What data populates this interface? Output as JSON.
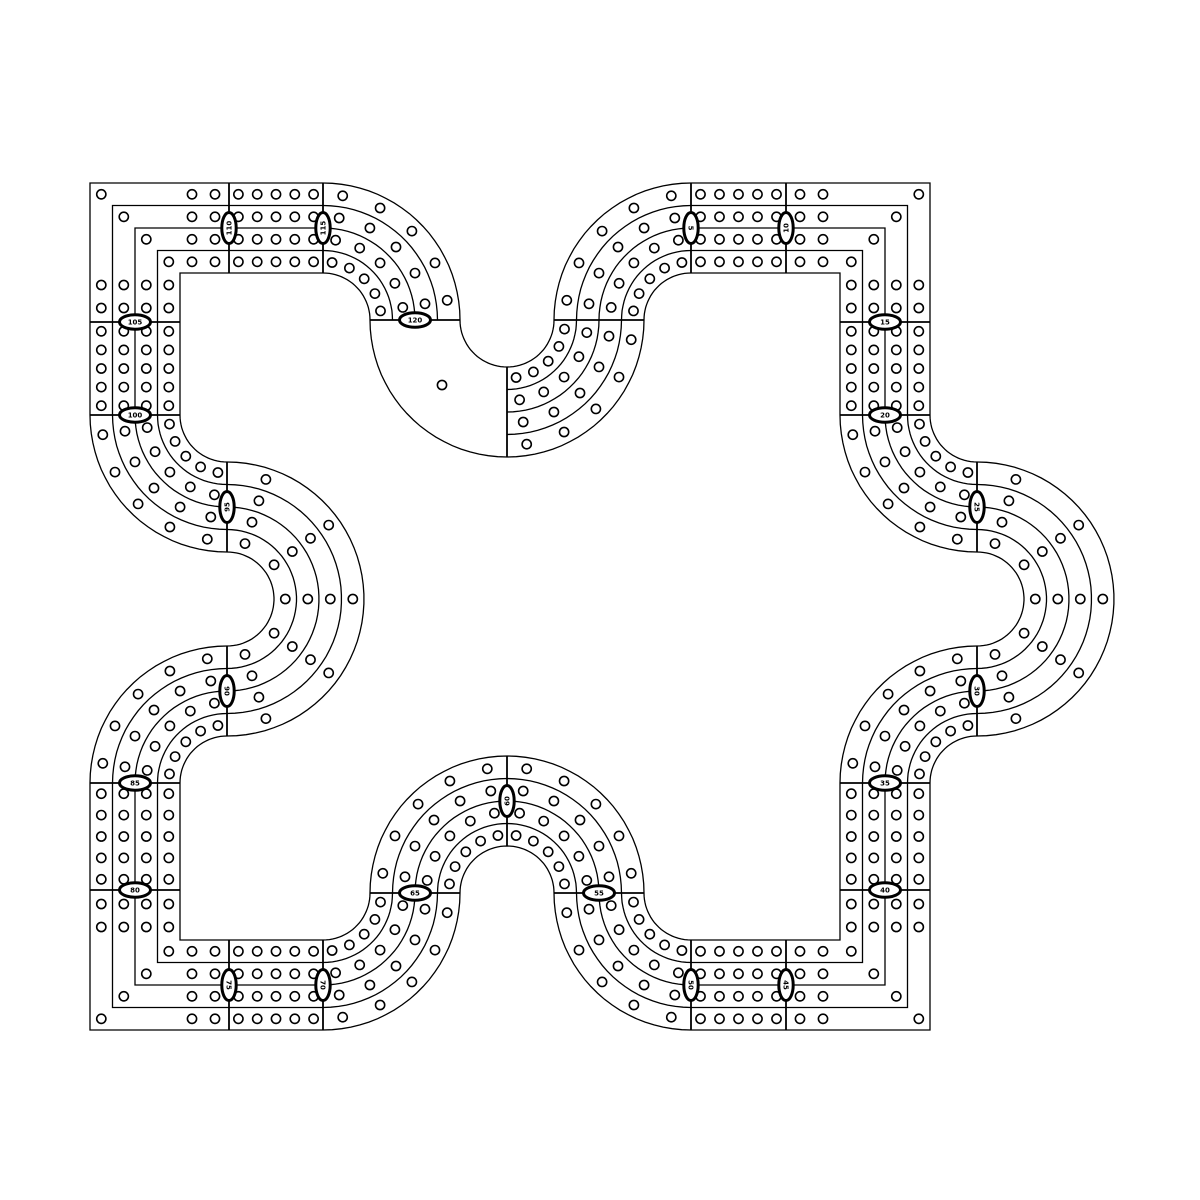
{
  "page": {
    "background": "#ffffff"
  },
  "drawing": {
    "description": "Modular four-lane cribbage race track template, black line art on white",
    "ink": "#000000",
    "background": "#ffffff",
    "lane_count": 4,
    "holes_per_module": 5,
    "modules": 25,
    "hole_radius": 4.6,
    "band_width": 90,
    "arc_radius": 92,
    "line_offsets": [
      45,
      22.5,
      0,
      -22.5,
      -45
    ],
    "lane_offsets": [
      33.75,
      11.25,
      -11.25,
      -33.75
    ],
    "corner_hole_insets": [
      14,
      37
    ],
    "stroke": {
      "track": 1.3,
      "boundary": 1.8,
      "hole": 1.6,
      "marker_ring": 3
    },
    "marker_ellipse": {
      "rx": 15.5,
      "ry": 7.2,
      "font_size": 7
    },
    "start_line_note": "vertical start line at top center",
    "finish_hole": {
      "x": 442,
      "y": 385
    },
    "segments": [
      {
        "t": "arc",
        "cx": 507,
        "cy": 320,
        "a0": 90,
        "a1": 0,
        "marker": null
      },
      {
        "t": "arc",
        "cx": 691,
        "cy": 320,
        "a0": 180,
        "a1": 270,
        "marker": "5"
      },
      {
        "t": "line",
        "x1": 691,
        "y1": 228,
        "x2": 786,
        "y2": 228,
        "marker": "10"
      },
      {
        "t": "corner",
        "vx": 885,
        "vy": 228,
        "sx": 1,
        "sy": -1,
        "x1": 786,
        "y1": 228,
        "x2": 885,
        "y2": 322,
        "marker": "15"
      },
      {
        "t": "line",
        "x1": 885,
        "y1": 322,
        "x2": 885,
        "y2": 415,
        "marker": "20"
      },
      {
        "t": "arc",
        "cx": 977,
        "cy": 415,
        "a0": 180,
        "a1": 90,
        "marker": "25"
      },
      {
        "t": "arc",
        "cx": 977,
        "cy": 599,
        "a0": 270,
        "a1": 450,
        "marker": "30"
      },
      {
        "t": "arc",
        "cx": 977,
        "cy": 783,
        "a0": 270,
        "a1": 180,
        "marker": "35"
      },
      {
        "t": "line",
        "x1": 885,
        "y1": 783,
        "x2": 885,
        "y2": 890,
        "marker": "40"
      },
      {
        "t": "corner",
        "vx": 885,
        "vy": 985,
        "sx": 1,
        "sy": 1,
        "x1": 885,
        "y1": 890,
        "x2": 786,
        "y2": 985,
        "marker": "45"
      },
      {
        "t": "line",
        "x1": 786,
        "y1": 985,
        "x2": 691,
        "y2": 985,
        "marker": "50"
      },
      {
        "t": "arc",
        "cx": 691,
        "cy": 893,
        "a0": 90,
        "a1": 180,
        "marker": "55"
      },
      {
        "t": "arc",
        "cx": 507,
        "cy": 893,
        "a0": 0,
        "a1": -90,
        "marker": "60"
      },
      {
        "t": "arc",
        "cx": 507,
        "cy": 893,
        "a0": -90,
        "a1": -180,
        "marker": "65"
      },
      {
        "t": "arc",
        "cx": 323,
        "cy": 893,
        "a0": 0,
        "a1": 90,
        "marker": "70"
      },
      {
        "t": "line",
        "x1": 323,
        "y1": 985,
        "x2": 229,
        "y2": 985,
        "marker": "75"
      },
      {
        "t": "corner",
        "vx": 135,
        "vy": 985,
        "sx": -1,
        "sy": 1,
        "x1": 229,
        "y1": 985,
        "x2": 135,
        "y2": 890,
        "marker": "80"
      },
      {
        "t": "line",
        "x1": 135,
        "y1": 890,
        "x2": 135,
        "y2": 783,
        "marker": "85"
      },
      {
        "t": "arc",
        "cx": 227,
        "cy": 783,
        "a0": 180,
        "a1": 270,
        "marker": "90"
      },
      {
        "t": "arc",
        "cx": 227,
        "cy": 599,
        "a0": 90,
        "a1": -90,
        "marker": "95"
      },
      {
        "t": "arc",
        "cx": 227,
        "cy": 415,
        "a0": 90,
        "a1": 180,
        "marker": "100"
      },
      {
        "t": "line",
        "x1": 135,
        "y1": 415,
        "x2": 135,
        "y2": 322,
        "marker": "105"
      },
      {
        "t": "corner",
        "vx": 135,
        "vy": 228,
        "sx": -1,
        "sy": -1,
        "x1": 135,
        "y1": 322,
        "x2": 229,
        "y2": 228,
        "marker": "110"
      },
      {
        "t": "line",
        "x1": 229,
        "y1": 228,
        "x2": 323,
        "y2": 228,
        "marker": "115"
      },
      {
        "t": "arc",
        "cx": 323,
        "cy": 320,
        "a0": 270,
        "a1": 360,
        "marker": "120"
      },
      {
        "t": "arc",
        "cx": 507,
        "cy": 320,
        "a0": 180,
        "a1": 90,
        "marker": null,
        "finish": true
      }
    ]
  }
}
